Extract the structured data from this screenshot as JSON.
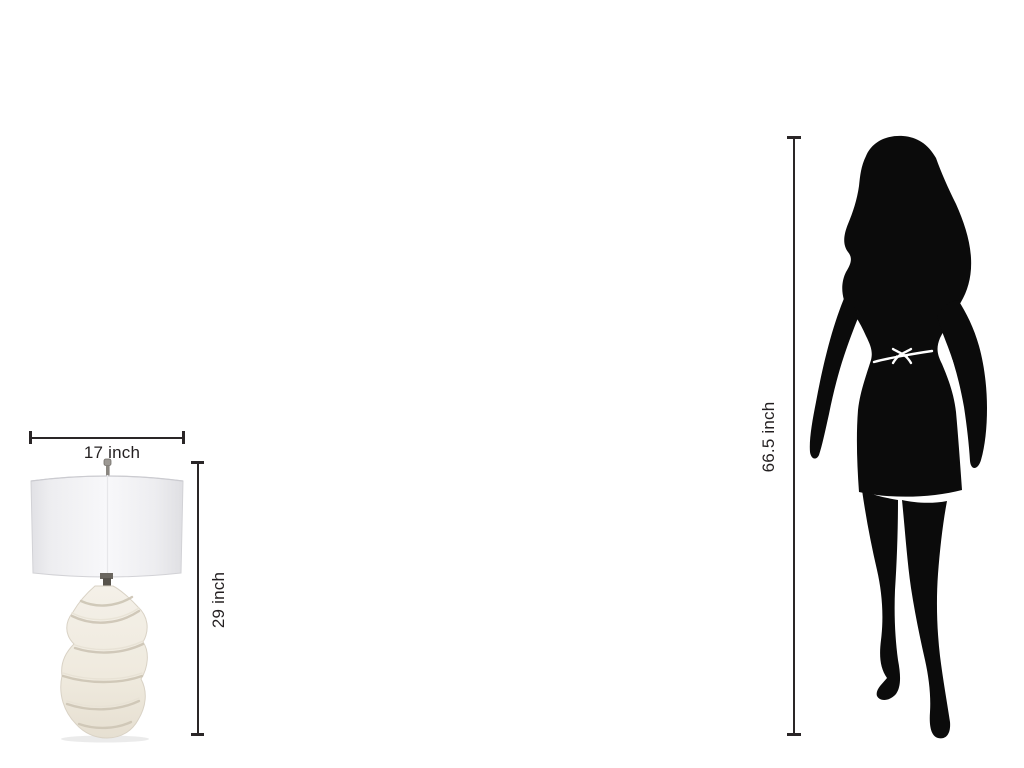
{
  "figure": {
    "item": {
      "type": "table-lamp",
      "width_label": "17 inch",
      "height_label": "29 inch"
    },
    "reference": {
      "type": "woman-silhouette",
      "height_label": "66.5 inch"
    }
  },
  "colors": {
    "background": "#ffffff",
    "dimension_line": "#2a2627",
    "label_text": "#231f20",
    "silhouette": "#0b0b0b",
    "lamp_shade": "#f1f1f4",
    "lamp_base": "#efeade"
  }
}
